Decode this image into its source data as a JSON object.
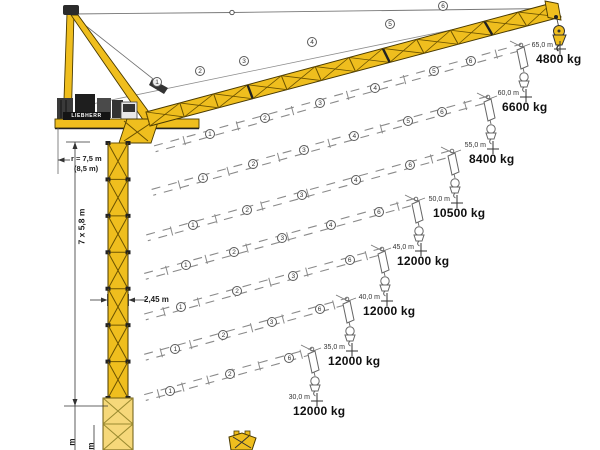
{
  "diagram": {
    "type": "crane-jib-configuration-load-diagram",
    "brand": "LIEBHERR",
    "dimensions": {
      "tail_radius": "r = 7,5 m",
      "tail_radius_alt": "(8,5 m)",
      "tower_sections": "7 x 5,8 m",
      "tower_width": "2,45 m",
      "bottom_cut_label_1": "m",
      "bottom_cut_label_2": "m"
    },
    "configurations": [
      {
        "radius_label": "65,0 m",
        "capacity_label": "4800 kg",
        "radius_m": 65,
        "capacity_kg": 4800,
        "marker_x": 560,
        "marker_y": 49,
        "style": "solid",
        "sections": [
          1,
          2,
          3,
          4,
          5,
          6
        ]
      },
      {
        "radius_label": "60,0 m",
        "capacity_label": "6600 kg",
        "radius_m": 60,
        "capacity_kg": 6600,
        "marker_x": 526,
        "marker_y": 97,
        "style": "dashed",
        "sections": [
          1,
          2,
          3,
          4,
          5,
          6
        ]
      },
      {
        "radius_label": "55,0 m",
        "capacity_label": "8400 kg",
        "radius_m": 55,
        "capacity_kg": 8400,
        "marker_x": 493,
        "marker_y": 149,
        "style": "dashed",
        "sections": [
          1,
          2,
          3,
          4,
          5,
          6
        ]
      },
      {
        "radius_label": "50,0 m",
        "capacity_label": "10500 kg",
        "radius_m": 50,
        "capacity_kg": 10500,
        "marker_x": 457,
        "marker_y": 203,
        "style": "dashed",
        "sections": [
          1,
          2,
          3,
          4,
          6
        ]
      },
      {
        "radius_label": "45,0 m",
        "capacity_label": "12000 kg",
        "radius_m": 45,
        "capacity_kg": 12000,
        "marker_x": 421,
        "marker_y": 251,
        "style": "dashed",
        "sections": [
          1,
          2,
          3,
          4,
          6
        ]
      },
      {
        "radius_label": "40,0 m",
        "capacity_label": "12000 kg",
        "radius_m": 40,
        "capacity_kg": 12000,
        "marker_x": 387,
        "marker_y": 301,
        "style": "dashed",
        "sections": [
          1,
          2,
          3,
          6
        ]
      },
      {
        "radius_label": "35,0 m",
        "capacity_label": "12000 kg",
        "radius_m": 35,
        "capacity_kg": 12000,
        "marker_x": 352,
        "marker_y": 351,
        "style": "dashed",
        "sections": [
          1,
          2,
          3,
          6
        ]
      },
      {
        "radius_label": "30,0 m",
        "capacity_label": "12000 kg",
        "radius_m": 30,
        "capacity_kg": 12000,
        "marker_x": 317,
        "marker_y": 401,
        "style": "dashed",
        "sections": [
          1,
          2,
          6
        ]
      }
    ],
    "solid_jib_markers": [
      {
        "n": "1",
        "x": 157,
        "y": 82
      },
      {
        "n": "2",
        "x": 200,
        "y": 71
      },
      {
        "n": "3",
        "x": 244,
        "y": 61
      },
      {
        "n": "4",
        "x": 312,
        "y": 42
      },
      {
        "n": "5",
        "x": 390,
        "y": 24
      },
      {
        "n": "6",
        "x": 443,
        "y": 6
      }
    ],
    "colors": {
      "crane_yellow": "#EFBE1E",
      "crane_outline": "#4a3a00",
      "dashed_gray": "#8a8a8a",
      "label_dark": "#101010"
    }
  },
  "chart_data": {
    "type": "table",
    "columns": [
      "jib_radius_m",
      "max_capacity_kg"
    ],
    "rows": [
      [
        65,
        4800
      ],
      [
        60,
        6600
      ],
      [
        55,
        8400
      ],
      [
        50,
        10500
      ],
      [
        45,
        12000
      ],
      [
        40,
        12000
      ],
      [
        35,
        12000
      ],
      [
        30,
        12000
      ]
    ]
  }
}
